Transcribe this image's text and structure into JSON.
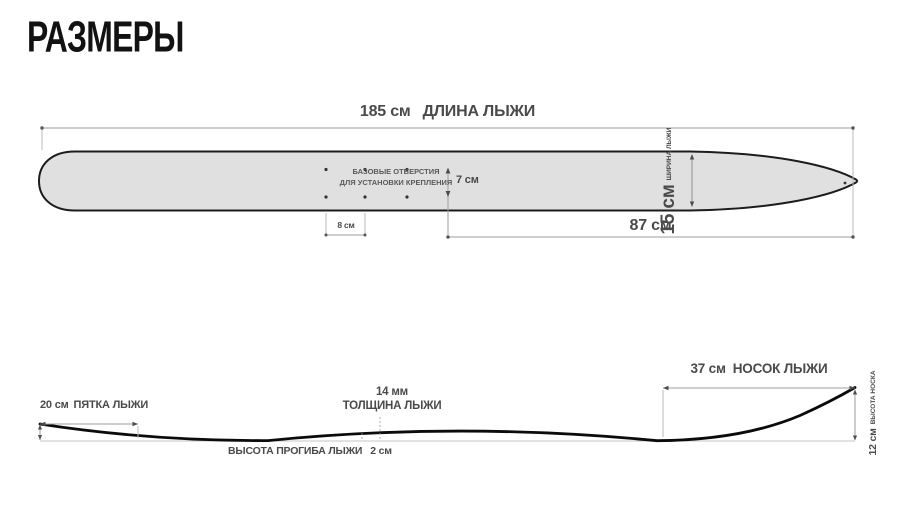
{
  "title": "РАЗМЕРЫ",
  "top_view": {
    "length_value": "185 см",
    "length_label": "ДЛИНА ЛЫЖИ",
    "width_value": "15 см",
    "width_label": "ШИРИНА ЛЫЖИ",
    "holes_note_line1": "БАЗОВЫЕ ОТВЕРСТИЯ",
    "holes_note_line2": "ДЛЯ УСТАНОВКИ КРЕПЛЕНИЯ",
    "holes_row_spacing": "7 см",
    "holes_col_spacing": "8 см",
    "front_section_value": "87 см"
  },
  "side_view": {
    "tail_value": "20 см",
    "tail_label": "ПЯТКА ЛЫЖИ",
    "thickness_value": "14 мм",
    "thickness_label": "ТОЛЩИНА ЛЫЖИ",
    "camber_label": "ВЫСОТА ПРОГИБА ЛЫЖИ",
    "camber_value": "2 см",
    "tip_value": "37 см",
    "tip_label": "НОСОК ЛЫЖИ",
    "tip_height_value": "12 см",
    "tip_height_label": "ВЫСОТА НОСКА"
  },
  "colors": {
    "ski_fill": "#e0e0e0",
    "ski_outline": "#1c1c1c",
    "dimension_line": "#9e9e9e",
    "text": "#4a4a4a"
  }
}
